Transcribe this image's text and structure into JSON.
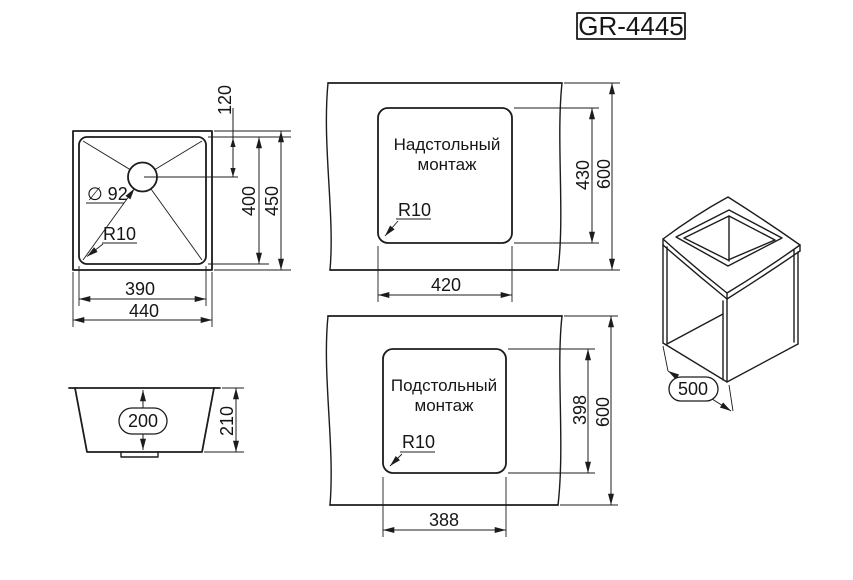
{
  "title": "GR-4445",
  "top_view": {
    "inner_width": "390",
    "outer_width": "440",
    "inner_depth": "400",
    "outer_depth": "450",
    "drain_offset": "120",
    "drain_diameter": "∅ 92",
    "corner_radius": "R10"
  },
  "side_view": {
    "bowl_depth": "200",
    "overall_height": "210"
  },
  "overmount_view": {
    "caption_line1": "Надстольный",
    "caption_line2": "монтаж",
    "cutout_width": "420",
    "cutout_height": "430",
    "counter_depth": "600",
    "corner_radius": "R10"
  },
  "undermount_view": {
    "caption_line1": "Подстольный",
    "caption_line2": "монтаж",
    "cutout_width": "388",
    "cutout_height": "398",
    "counter_depth": "600",
    "corner_radius": "R10"
  },
  "cabinet_view": {
    "cabinet_width": "500"
  },
  "colors": {
    "line": "#1c1c1c",
    "background": "#ffffff"
  }
}
